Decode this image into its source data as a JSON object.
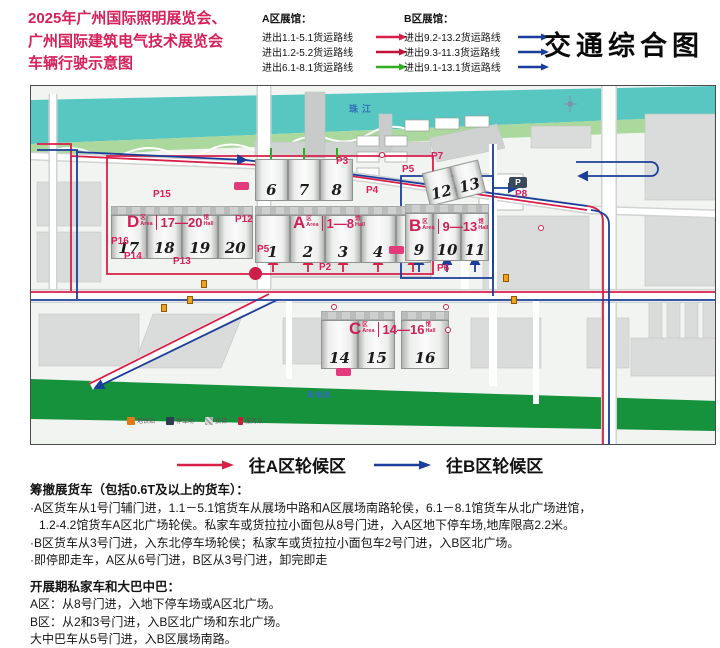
{
  "title": {
    "lines": [
      "2025年广州国际照明展览会、",
      "广州国际建筑电气技术展览会",
      "车辆行驶示意图"
    ]
  },
  "header": {
    "map_title": "交通综合图",
    "legend_a": {
      "title": "A区展馆：",
      "items": [
        {
          "label": "进出1.1-5.1货运路线",
          "color": "#d81f48"
        },
        {
          "label": "进出1.2-5.2货运路线",
          "color": "#c41236"
        },
        {
          "label": "进出6.1-8.1货运路线",
          "color": "#2ead1f"
        }
      ]
    },
    "legend_b": {
      "title": "B区展馆：",
      "items": [
        {
          "label": "进出9.2-13.2货运路线",
          "color": "#1a3e99"
        },
        {
          "label": "进出9.3-11.3货运路线",
          "color": "#1a3e99"
        },
        {
          "label": "进出9.1-13.1货运路线",
          "color": "#1a3e99"
        }
      ]
    }
  },
  "map": {
    "river_label": "珠江",
    "creek_label": "黄埔涌",
    "zones": {
      "d": {
        "letter": "D",
        "suffix": "区",
        "suffix_en": "Area",
        "range": "17—20",
        "unit": "馆",
        "unit_en": "Hall"
      },
      "a": {
        "letter": "A",
        "suffix": "区",
        "suffix_en": "Area",
        "range": "1—8",
        "unit": "馆",
        "unit_en": "Hall"
      },
      "b": {
        "letter": "B",
        "suffix": "区",
        "suffix_en": "Area",
        "range": "9—13",
        "unit": "馆",
        "unit_en": "Hall"
      },
      "c": {
        "letter": "C",
        "suffix": "区",
        "suffix_en": "Area",
        "range": "14—16",
        "unit": "馆",
        "unit_en": "Hall"
      }
    },
    "halls": {
      "d": [
        "17",
        "18",
        "19",
        "20"
      ],
      "a_top": [
        "6",
        "7",
        "8"
      ],
      "a": [
        "1",
        "2",
        "3",
        "4",
        "5"
      ],
      "b_top": [
        "12",
        "13"
      ],
      "b": [
        "9",
        "10",
        "11"
      ],
      "c": [
        "14",
        "15"
      ],
      "c2": [
        "16"
      ]
    },
    "parking": {
      "p15": "P15",
      "p12": "P12",
      "p16": "P16",
      "p14": "P14",
      "p13": "P13",
      "p5a": "P5",
      "p2": "P2",
      "p3": "P3",
      "p4": "P4",
      "p5b": "P5",
      "p7": "P7",
      "p8": "P8",
      "p6": "P6",
      "p_icon": "P"
    },
    "mini_legend": [
      {
        "icon": "metro-icon",
        "label": "地铁站"
      },
      {
        "icon": "parking-icon",
        "label": "停车场"
      },
      {
        "icon": "escalator-icon",
        "label": "扶梯"
      },
      {
        "icon": "service-icon",
        "label": "服务点"
      }
    ]
  },
  "waiting_legend": {
    "a_label": "往A区轮候区",
    "b_label": "往B区轮候区"
  },
  "notes": {
    "heading1": "筹撤展货车（包括0.6T及以上的货车）：",
    "lines1": [
      "·A区货车从1号门辅门进，1.1－5.1馆货车从展场中路和A区展场南路轮侯，6.1－8.1馆货车从北广场进馆，",
      "1.2-4.2馆货车A区北广场轮侯。私家车或货拉拉小面包从8号门进，入A区地下停车场,地库限高2.2米。",
      "·B区货车从3号门进，入东北停车场轮侯；私家车或货拉拉小面包车2号门进，入B区北广场。",
      "·即停即走车，A区从6号门进，B区从3号门进，卸完即走"
    ],
    "heading2": "开展期私家车和大巴中巴：",
    "lines2": [
      "A区：从8号门进，入地下停车场或A区北广场。",
      "B区：从2和3号门进，入B区北广场和东北广场。",
      "大中巴车从5号门进，入B区展场南路。"
    ]
  },
  "colors": {
    "title_red": "#d6205a",
    "zone_pink": "#d01e56",
    "parking_pink": "#dc1f5c",
    "route_red": "#d81f48",
    "route_red2": "#c41236",
    "route_green": "#2ead1f",
    "route_blue": "#1a3e99",
    "river": "#58c7c2",
    "park_green": "#abd89c",
    "south_green": "#17923c"
  }
}
